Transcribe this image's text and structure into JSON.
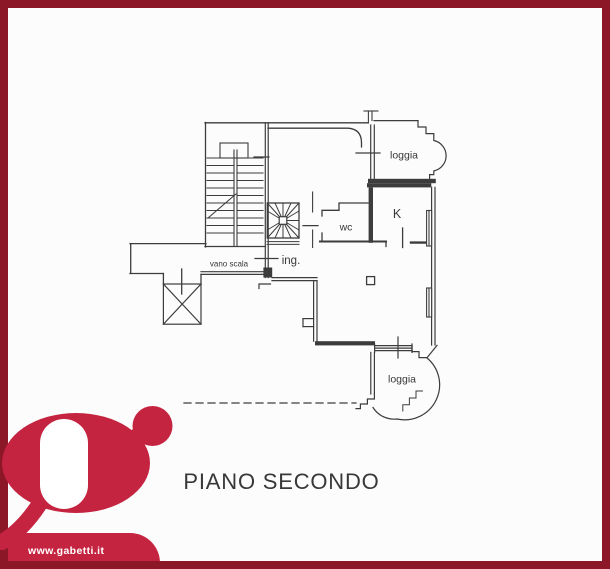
{
  "colors": {
    "border": "#8C1727",
    "brand": "#C52441",
    "line": "#3C3C3C",
    "background": "#FCFCFC",
    "label_text": "#383838"
  },
  "floor_plan": {
    "title": "PIANO SECONDO",
    "labels": {
      "loggia_top": "loggia",
      "kitchen": "K",
      "wc": "wc",
      "entrance": "ing.",
      "stairwell": "vano scala",
      "loggia_bottom": "loggia"
    }
  },
  "branding": {
    "website": "www.gabetti.it",
    "logo_icon": "gabetti-g-logo"
  }
}
